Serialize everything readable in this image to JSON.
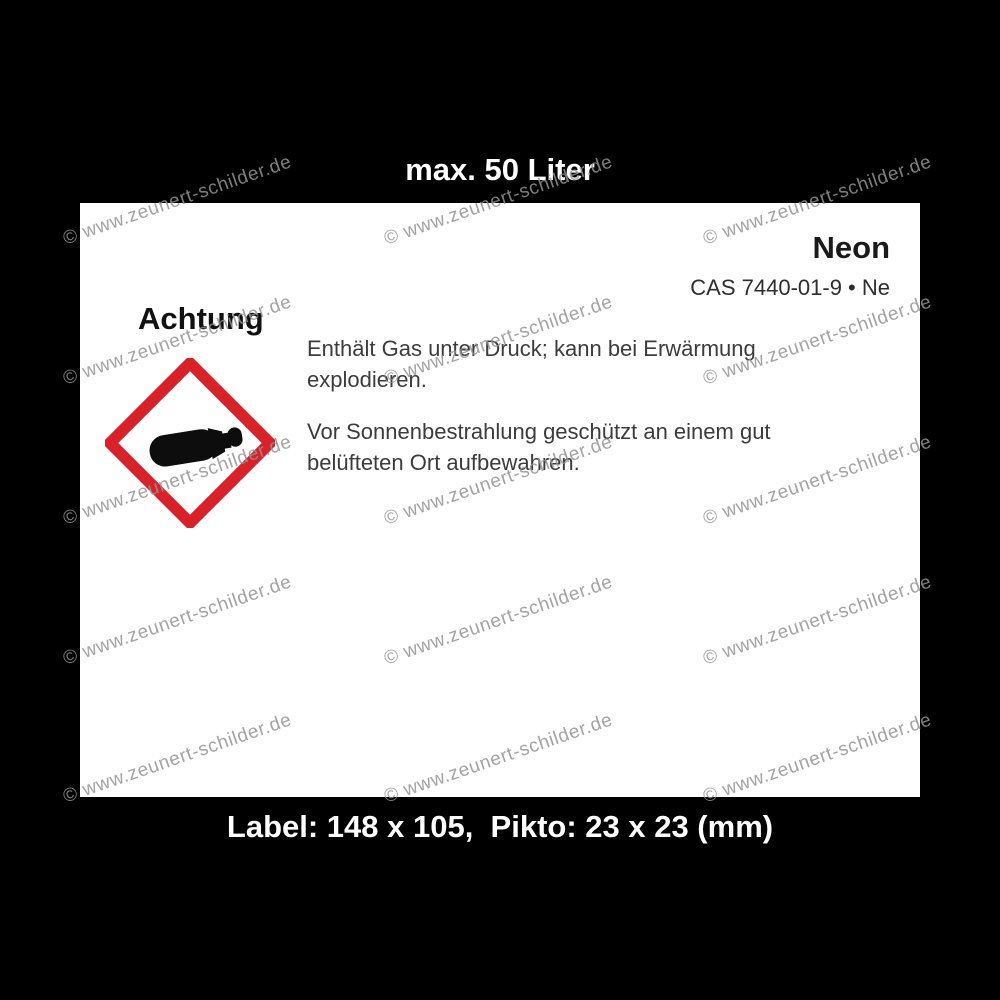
{
  "image": {
    "background_color": "#000000",
    "label_background_color": "#ffffff"
  },
  "captions": {
    "top": "max. 50 Liter",
    "bottom": "Label: 148 x 105,  Pikto: 23 x 23 (mm)"
  },
  "label": {
    "product_name": "Neon",
    "cas_line": "CAS 7440-01-9 • Ne",
    "signal_word": "Achtung",
    "hazard_lines": [
      "Enthält Gas unter Druck; kann bei Erwärmung",
      "explodieren."
    ],
    "precaution_lines": [
      "Vor Sonnenbestrahlung geschützt an einem gut",
      "belüfteten Ort aufbewahren."
    ],
    "pictogram": {
      "name": "ghs04-gas-cylinder-under-pressure",
      "border_color": "#da2128",
      "symbol_color": "#0d0d0d"
    }
  },
  "watermark": {
    "text": "© www.zeunert-schilder.de",
    "color": "#949494"
  }
}
